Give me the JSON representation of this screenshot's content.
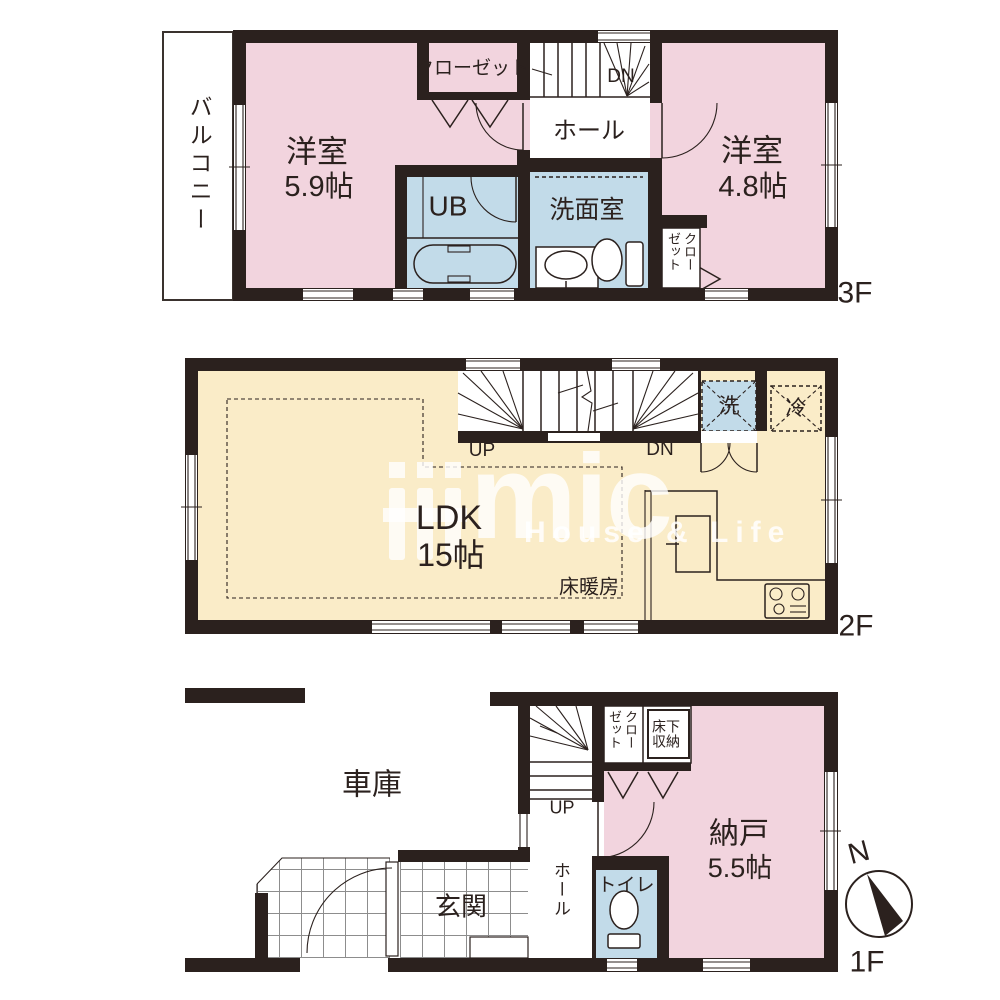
{
  "colors": {
    "wall": "#2b211e",
    "room_pink": "#f2d4de",
    "wet_blue": "#c2dbe9",
    "ldk_cream": "#faecc8",
    "watermark_white": "#ffffff"
  },
  "watermark": {
    "logo": "mic",
    "tagline": "House & Life"
  },
  "f3": {
    "floor_label": "3F",
    "balcony": "バルコニー",
    "closet": "クローゼット",
    "dn": "DN",
    "hall": "ホール",
    "room_a_name": "洋室",
    "room_a_size": "5.9帖",
    "bath": "UB",
    "washroom": "洗面室",
    "room_b_name": "洋室",
    "room_b_size": "4.8帖",
    "closet_b": "クローゼット"
  },
  "f2": {
    "floor_label": "2F",
    "up": "UP",
    "dn": "DN",
    "laundry": "洗",
    "fridge": "冷",
    "ldk_name": "LDK",
    "ldk_size": "15帖",
    "floor_heating": "床暖房"
  },
  "f1": {
    "floor_label": "1F",
    "garage": "車庫",
    "up": "UP",
    "hall": "ホール",
    "closet": "クローゼット",
    "underfloor_storage": "床下収納",
    "storage_name": "納戸",
    "storage_size": "5.5帖",
    "entrance": "玄関",
    "toilet": "トイレ",
    "north": "N"
  }
}
